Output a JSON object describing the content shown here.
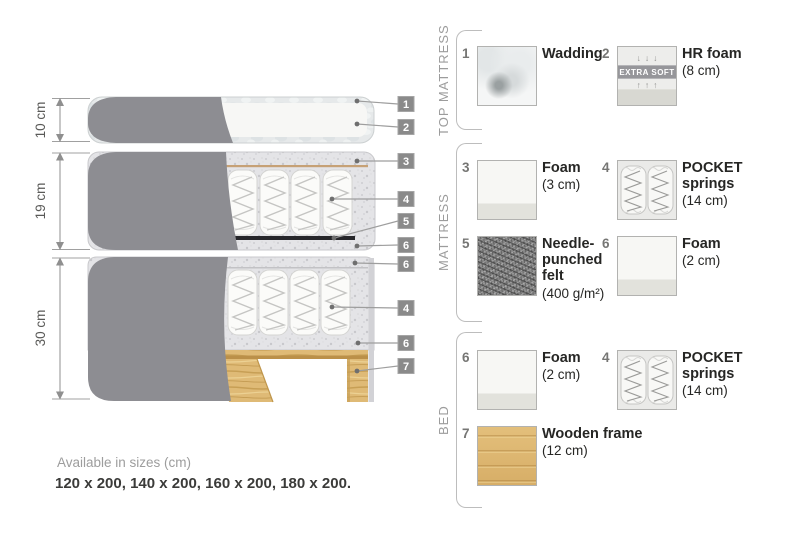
{
  "diagram": {
    "dimensions": [
      {
        "label": "10 cm"
      },
      {
        "label": "19 cm"
      },
      {
        "label": "30 cm"
      }
    ],
    "callouts": [
      "1",
      "2",
      "3",
      "4",
      "5",
      "6",
      "6",
      "4",
      "6",
      "7"
    ]
  },
  "legend": {
    "sections": [
      {
        "title": "TOP MATTRESS",
        "items": [
          {
            "num": "1",
            "name": "Wadding",
            "detail": ""
          },
          {
            "num": "2",
            "name": "HR foam",
            "detail": "(8 cm)",
            "badge": "EXTRA SOFT",
            "arrows_down": "↓↓↓",
            "arrows_up": "↑↑↑"
          }
        ]
      },
      {
        "title": "MATTRESS",
        "items": [
          {
            "num": "3",
            "name": "Foam",
            "detail": "(3 cm)"
          },
          {
            "num": "4",
            "name": "POCKET springs",
            "detail": "(14 cm)"
          },
          {
            "num": "5",
            "name": "Needle-punched felt",
            "detail": "(400 g/m²)"
          },
          {
            "num": "6",
            "name": "Foam",
            "detail": "(2 cm)"
          }
        ]
      },
      {
        "title": "BED",
        "items": [
          {
            "num": "6",
            "name": "Foam",
            "detail": "(2 cm)"
          },
          {
            "num": "4",
            "name": "POCKET springs",
            "detail": "(14 cm)"
          },
          {
            "num": "7",
            "name": "Wooden frame",
            "detail": "(12 cm)"
          }
        ]
      }
    ]
  },
  "footer": {
    "line1": "Available in sizes (cm)",
    "line2": "120 x 200, 140 x 200, 160 x 200, 180 x 200."
  },
  "colors": {
    "fabric_grey": "#8d8d92",
    "foam_speckle_base": "#e4e4e7",
    "wood": "#dfba76",
    "felt_dark": "#26262a",
    "callout_badge_grey": "#8a8a8a"
  }
}
